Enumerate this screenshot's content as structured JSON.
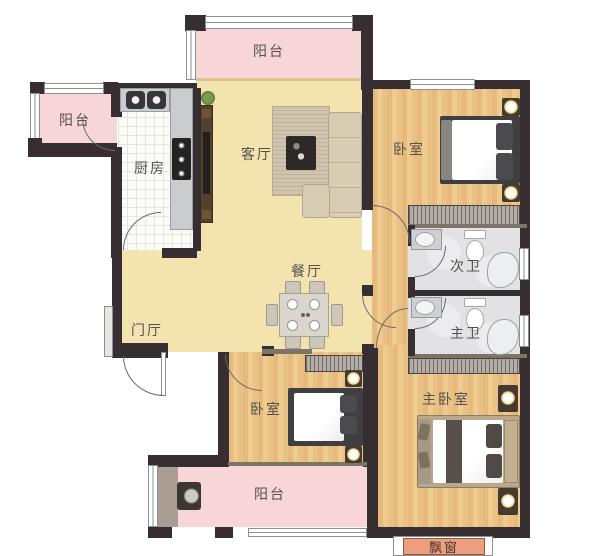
{
  "plan_type": "apartment-floor-plan",
  "rooms": {
    "balcony_top": {
      "label": "阳台"
    },
    "balcony_left": {
      "label": "阳台"
    },
    "kitchen": {
      "label": "厨房"
    },
    "living_room": {
      "label": "客厅"
    },
    "bedroom_top": {
      "label": "卧室"
    },
    "bath_secondary": {
      "label": "次卫"
    },
    "bath_master": {
      "label": "主卫"
    },
    "dining_room": {
      "label": "餐厅"
    },
    "foyer": {
      "label": "门厅"
    },
    "bedroom_bottom": {
      "label": "卧室"
    },
    "bedroom_master": {
      "label": "主卧室"
    },
    "balcony_bottom": {
      "label": "阳台"
    },
    "bay_window": {
      "label": "飘窗"
    }
  },
  "fixtures": {
    "kitchen": [
      "double-sink",
      "counter",
      "gas-stove"
    ],
    "living_room": [
      "tv-cabinet",
      "tv",
      "plant",
      "rug",
      "coffee-table",
      "l-shaped-sofa"
    ],
    "dining_room": [
      "dining-table",
      "six-chairs",
      "plates"
    ],
    "bedroom_top": [
      "double-bed",
      "pillows",
      "nightstand-lamps",
      "wardrobe",
      "window"
    ],
    "bath_secondary": [
      "washbasin",
      "toilet",
      "shower",
      "window",
      "door"
    ],
    "bath_master": [
      "washbasin",
      "toilet",
      "shower",
      "window",
      "door"
    ],
    "bedroom_bottom": [
      "double-bed",
      "pillows",
      "nightstand-lamps",
      "wardrobe"
    ],
    "bedroom_master": [
      "double-bed",
      "bench-pillows",
      "nightstand-lamps",
      "wardrobe",
      "bay-window"
    ],
    "balcony_bottom": [
      "washing-machine"
    ],
    "foyer": [
      "entry-door",
      "shoe-cabinet"
    ]
  },
  "colors": {
    "wall": "#362e31",
    "balcony_floor": "#f8d6d7",
    "main_floor": "#f3e3ae",
    "wood_floor": "#eac282",
    "bath_floor": "#e2e2e4",
    "kitchen_tile": "#fbfbf8",
    "bay_window": "#ec9e7f",
    "wardrobe": "#b3aea8",
    "label_text": "#55504e"
  }
}
